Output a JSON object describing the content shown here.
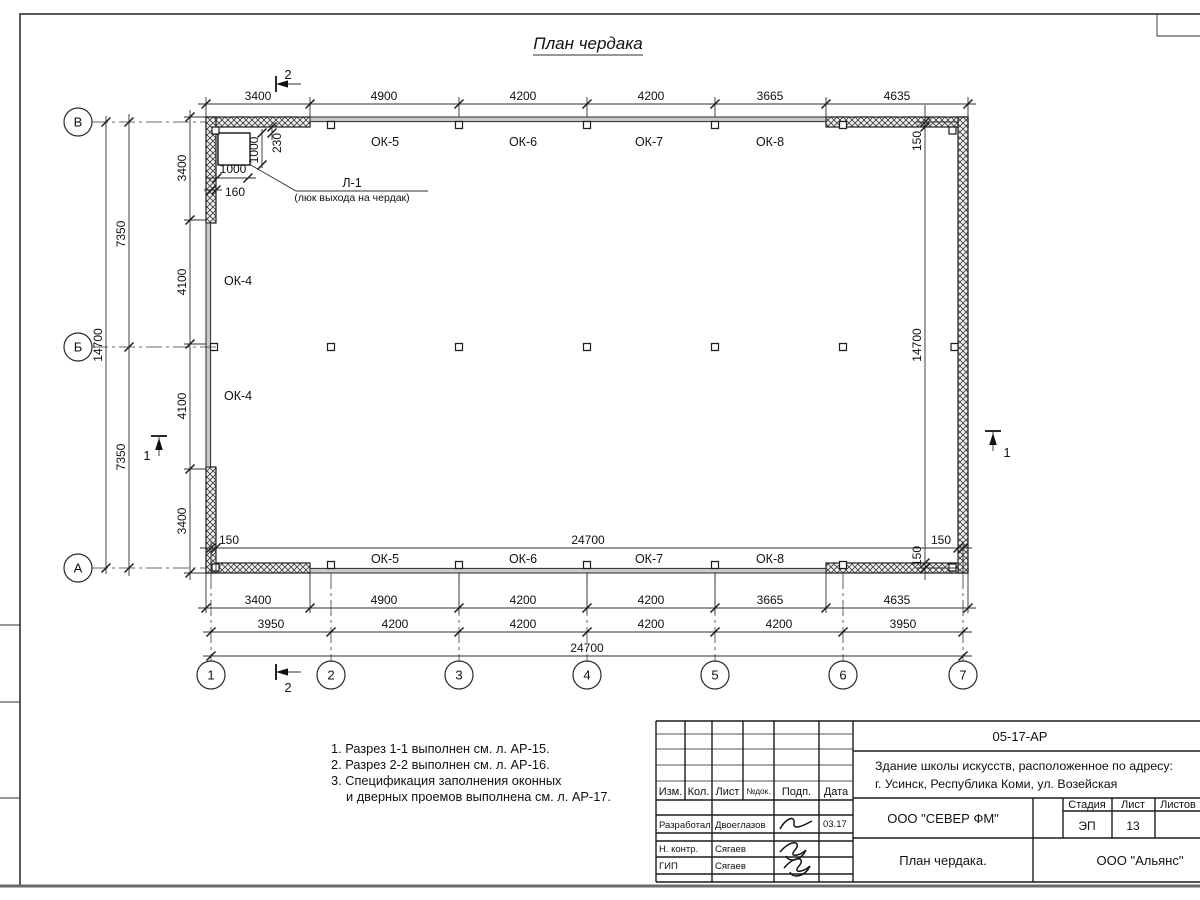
{
  "title": "План чердака",
  "axes": {
    "rows": [
      "В",
      "Б",
      "А"
    ],
    "cols": [
      "1",
      "2",
      "3",
      "4",
      "5",
      "6",
      "7"
    ]
  },
  "dims": {
    "top_chain": [
      "3400",
      "4900",
      "4200",
      "4200",
      "3665",
      "4635"
    ],
    "bottom_chain1": [
      "3400",
      "4900",
      "4200",
      "4200",
      "3665",
      "4635"
    ],
    "bottom_chain2": [
      "3950",
      "4200",
      "4200",
      "4200",
      "4200",
      "3950"
    ],
    "bottom_total": "24700",
    "inner_width": "24700",
    "inner_left_150": "150",
    "inner_right_150": "150",
    "left_chain": [
      "3400",
      "4100",
      "4100",
      "3400"
    ],
    "left_mid": [
      "7350",
      "7350"
    ],
    "left_total": "14700",
    "right_chain": [
      "150",
      "14700",
      "150"
    ]
  },
  "luk": {
    "label": "Л-1",
    "desc": "(люк выхода на чердак)",
    "dim_v": "1000",
    "dim_offset_v": "230",
    "dim_h": "1000",
    "dim_offset_h": "160"
  },
  "windows": {
    "top": [
      "ОК-5",
      "ОК-6",
      "ОК-7",
      "ОК-8"
    ],
    "bottom": [
      "ОК-5",
      "ОК-6",
      "ОК-7",
      "ОК-8"
    ],
    "left": [
      "ОК-4",
      "ОК-4"
    ]
  },
  "sections": {
    "s1": "1",
    "s2": "2"
  },
  "notes": [
    "1. Разрез 1-1 выполнен см. л. АР-15.",
    "2. Разрез 2-2 выполнен см. л. АР-16.",
    "3. Спецификация заполнения оконных",
    "и дверных проемов выполнена см. л. АР-17."
  ],
  "titleblock": {
    "doc_code": "05-17-АР",
    "project_line1": "Здание школы искусств, расположенное по адресу:",
    "project_line2": "г. Усинск, Республика Коми, ул. Возейская",
    "cols": [
      "Изм.",
      "Кол.",
      "Лист",
      "№док.",
      "Подп.",
      "Дата"
    ],
    "rows": [
      {
        "role": "Разработал",
        "name": "Двоеглазов",
        "date": "03.17"
      },
      {
        "role": "Н. контр.",
        "name": "Сягаев",
        "date": ""
      },
      {
        "role": "ГИП",
        "name": "Сягаев",
        "date": ""
      }
    ],
    "company": "ООО \"СЕВЕР ФМ\"",
    "drawing_title": "План чердака.",
    "stage_label": "Стадия",
    "sheet_label": "Лист",
    "sheets_label": "Листов",
    "stage": "ЭП",
    "sheet_number": "13",
    "org": "ООО \"Альянс\""
  }
}
